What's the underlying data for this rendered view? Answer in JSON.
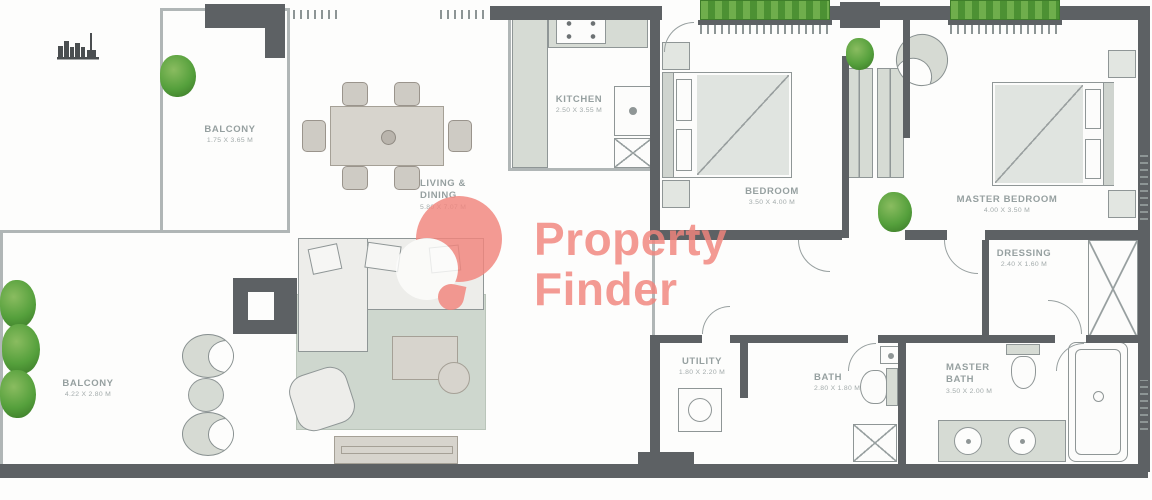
{
  "watermark": {
    "line1": "Property",
    "line2": "Finder"
  },
  "rooms": {
    "balcony_top": {
      "name": "BALCONY",
      "dims": "1.75 X 3.65 M"
    },
    "living_dining": {
      "name": "LIVING &\nDINING",
      "dims": "5.80 X 7.07 M"
    },
    "kitchen": {
      "name": "KITCHEN",
      "dims": "2.50 X 3.55 M"
    },
    "bedroom": {
      "name": "BEDROOM",
      "dims": "3.50 X 4.00 M"
    },
    "master_bedroom": {
      "name": "MASTER BEDROOM",
      "dims": "4.00 X 3.50 M"
    },
    "dressing": {
      "name": "DRESSING",
      "dims": "2.40 X 1.60 M"
    },
    "balcony_bottom": {
      "name": "BALCONY",
      "dims": "4.22 X 2.80 M"
    },
    "utility": {
      "name": "UTILITY",
      "dims": "1.80 X 2.20 M"
    },
    "bath": {
      "name": "BATH",
      "dims": "2.80 X 1.80 M"
    },
    "master_bath": {
      "name": "MASTER\nBATH",
      "dims": "3.50 X 2.00 M"
    }
  },
  "colors": {
    "wall": "#5d6164",
    "wall_light": "#98a0a0",
    "furniture_fill": "#d6dbd4",
    "furniture_tan": "#d7d4cd",
    "rug": "#c6d1c6",
    "plant": "#55a03c",
    "watermark": "#f2857d",
    "label": "#96a0a0"
  },
  "icons": {
    "skyline": "city-skyline",
    "logo": "property-finder-pin"
  }
}
